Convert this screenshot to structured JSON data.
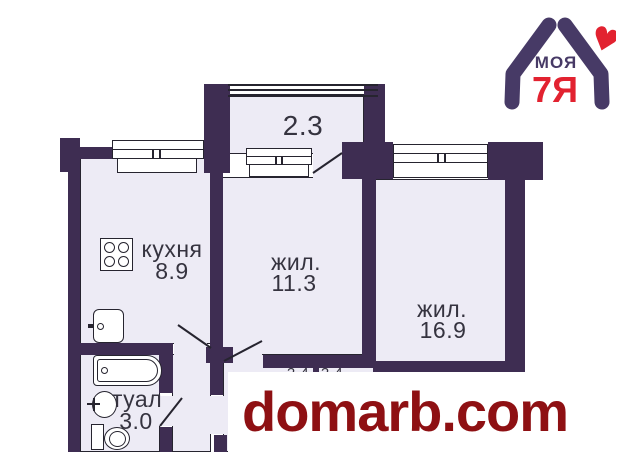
{
  "floorplan": {
    "balcony": {
      "area": "2.3"
    },
    "kitchen": {
      "name": "кухня",
      "area": "8.9"
    },
    "living_small": {
      "name": "жил.",
      "area": "11.3"
    },
    "living_large": {
      "name": "жил.",
      "area": "16.9"
    },
    "toilet": {
      "name": "туал",
      "area": "3.0"
    },
    "closet_left": {
      "area": "2.4"
    },
    "closet_right": {
      "area": "2.4"
    },
    "colors": {
      "wall": "#3e2d52",
      "room_fill": "#edebf5",
      "outline": "#26242f",
      "label_text": "#35333f"
    },
    "icons": [
      "stove-icon",
      "sink-icon",
      "bathtub-icon",
      "washbasin-icon",
      "toilet-icon",
      "window-icon",
      "door-swing-icon"
    ]
  },
  "logo": {
    "text_top": "МОЯ",
    "text_bottom": "7Я",
    "colors": {
      "purple": "#473a66",
      "red": "#e22230"
    },
    "icons": [
      "hands-house-icon",
      "heart-icon"
    ]
  },
  "watermark": {
    "text": "domarb.com",
    "color": "#8e1013"
  }
}
